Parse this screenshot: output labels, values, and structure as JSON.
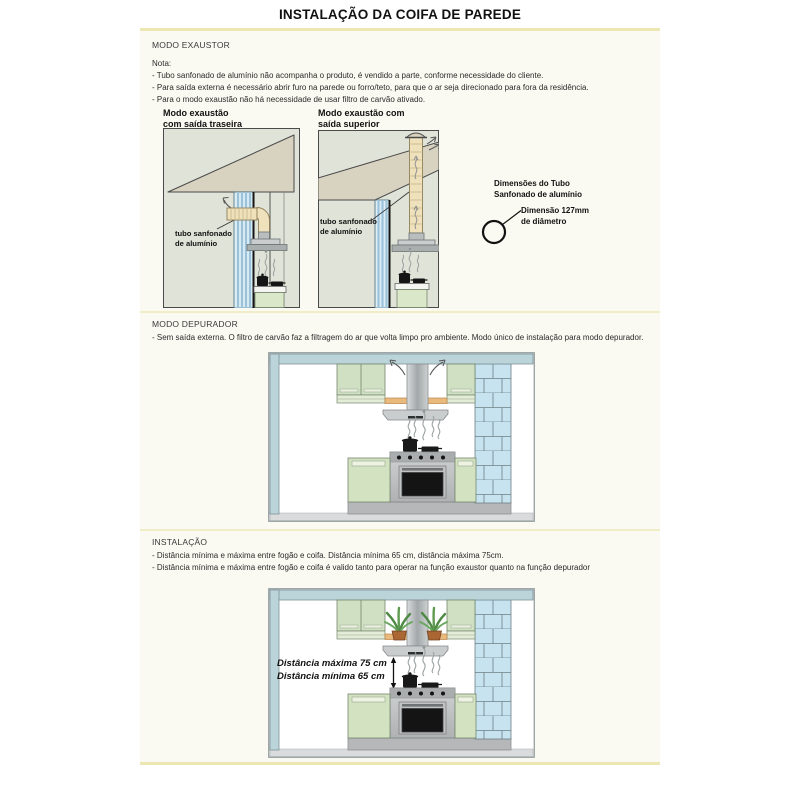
{
  "page": {
    "title": "INSTALAÇÃO DA COIFA DE PAREDE"
  },
  "exaustor": {
    "heading": "MODO EXAUSTOR",
    "note_label": "Nota:",
    "bullets": [
      "- Tubo sanfonado de alumínio não acompanha o produto, é vendido a parte, conforme necessidade do cliente.",
      "- Para saída externa é necessário abrir furo na parede ou forro/teto, para que o ar seja direcionado para fora da residência.",
      "- Para o modo exaustão não há necessidade de usar filtro de carvão ativado."
    ],
    "diagram_rear": {
      "title_line1": "Modo exaustão",
      "title_line2": "com saída traseira",
      "tube_label_line1": "tubo sanfonado",
      "tube_label_line2": "de alumínio"
    },
    "diagram_top": {
      "title_line1": "Modo exaustão com",
      "title_line2": "saída superior",
      "tube_label_line1": "tubo sanfonado",
      "tube_label_line2": "de alumínio"
    },
    "tube_dimensions": {
      "heading_line1": "Dimensões do Tubo",
      "heading_line2": "Sanfonado de alumínio",
      "dimension_line1": "Dimensão 127mm",
      "dimension_line2": "de diâmetro"
    }
  },
  "depurador": {
    "heading": "MODO DEPURADOR",
    "bullets": [
      "- Sem saída externa. O filtro de carvão faz a filtragem do ar que volta limpo pro ambiente. Modo único de instalação para modo depurador."
    ]
  },
  "instalacao": {
    "heading": "INSTALAÇÃO",
    "bullets": [
      "- Distância mínima e máxima entre fogão e coifa. Distância mínima 65 cm, distância máxima 75cm.",
      "- Distância mínima e máxima entre fogão e coifa é valido tanto para operar na função exaustor quanto na função depurador"
    ],
    "distance_max_label": "Distância máxima 75 cm",
    "distance_min_label": "Distância mínima 65 cm"
  },
  "colors": {
    "accent_rule": "#ece6b2",
    "panel_bg": "#fbfaf2",
    "diagram_bg": "#e0e3d8",
    "roof_tan": "#d8d3c1",
    "tube_beige": "#eee1bc",
    "cabinet_green": "#d3e2c1",
    "brick_blue": "#c6e3ef",
    "wall_teal": "#bad4d9",
    "shelf_orange": "#eaba7d"
  }
}
